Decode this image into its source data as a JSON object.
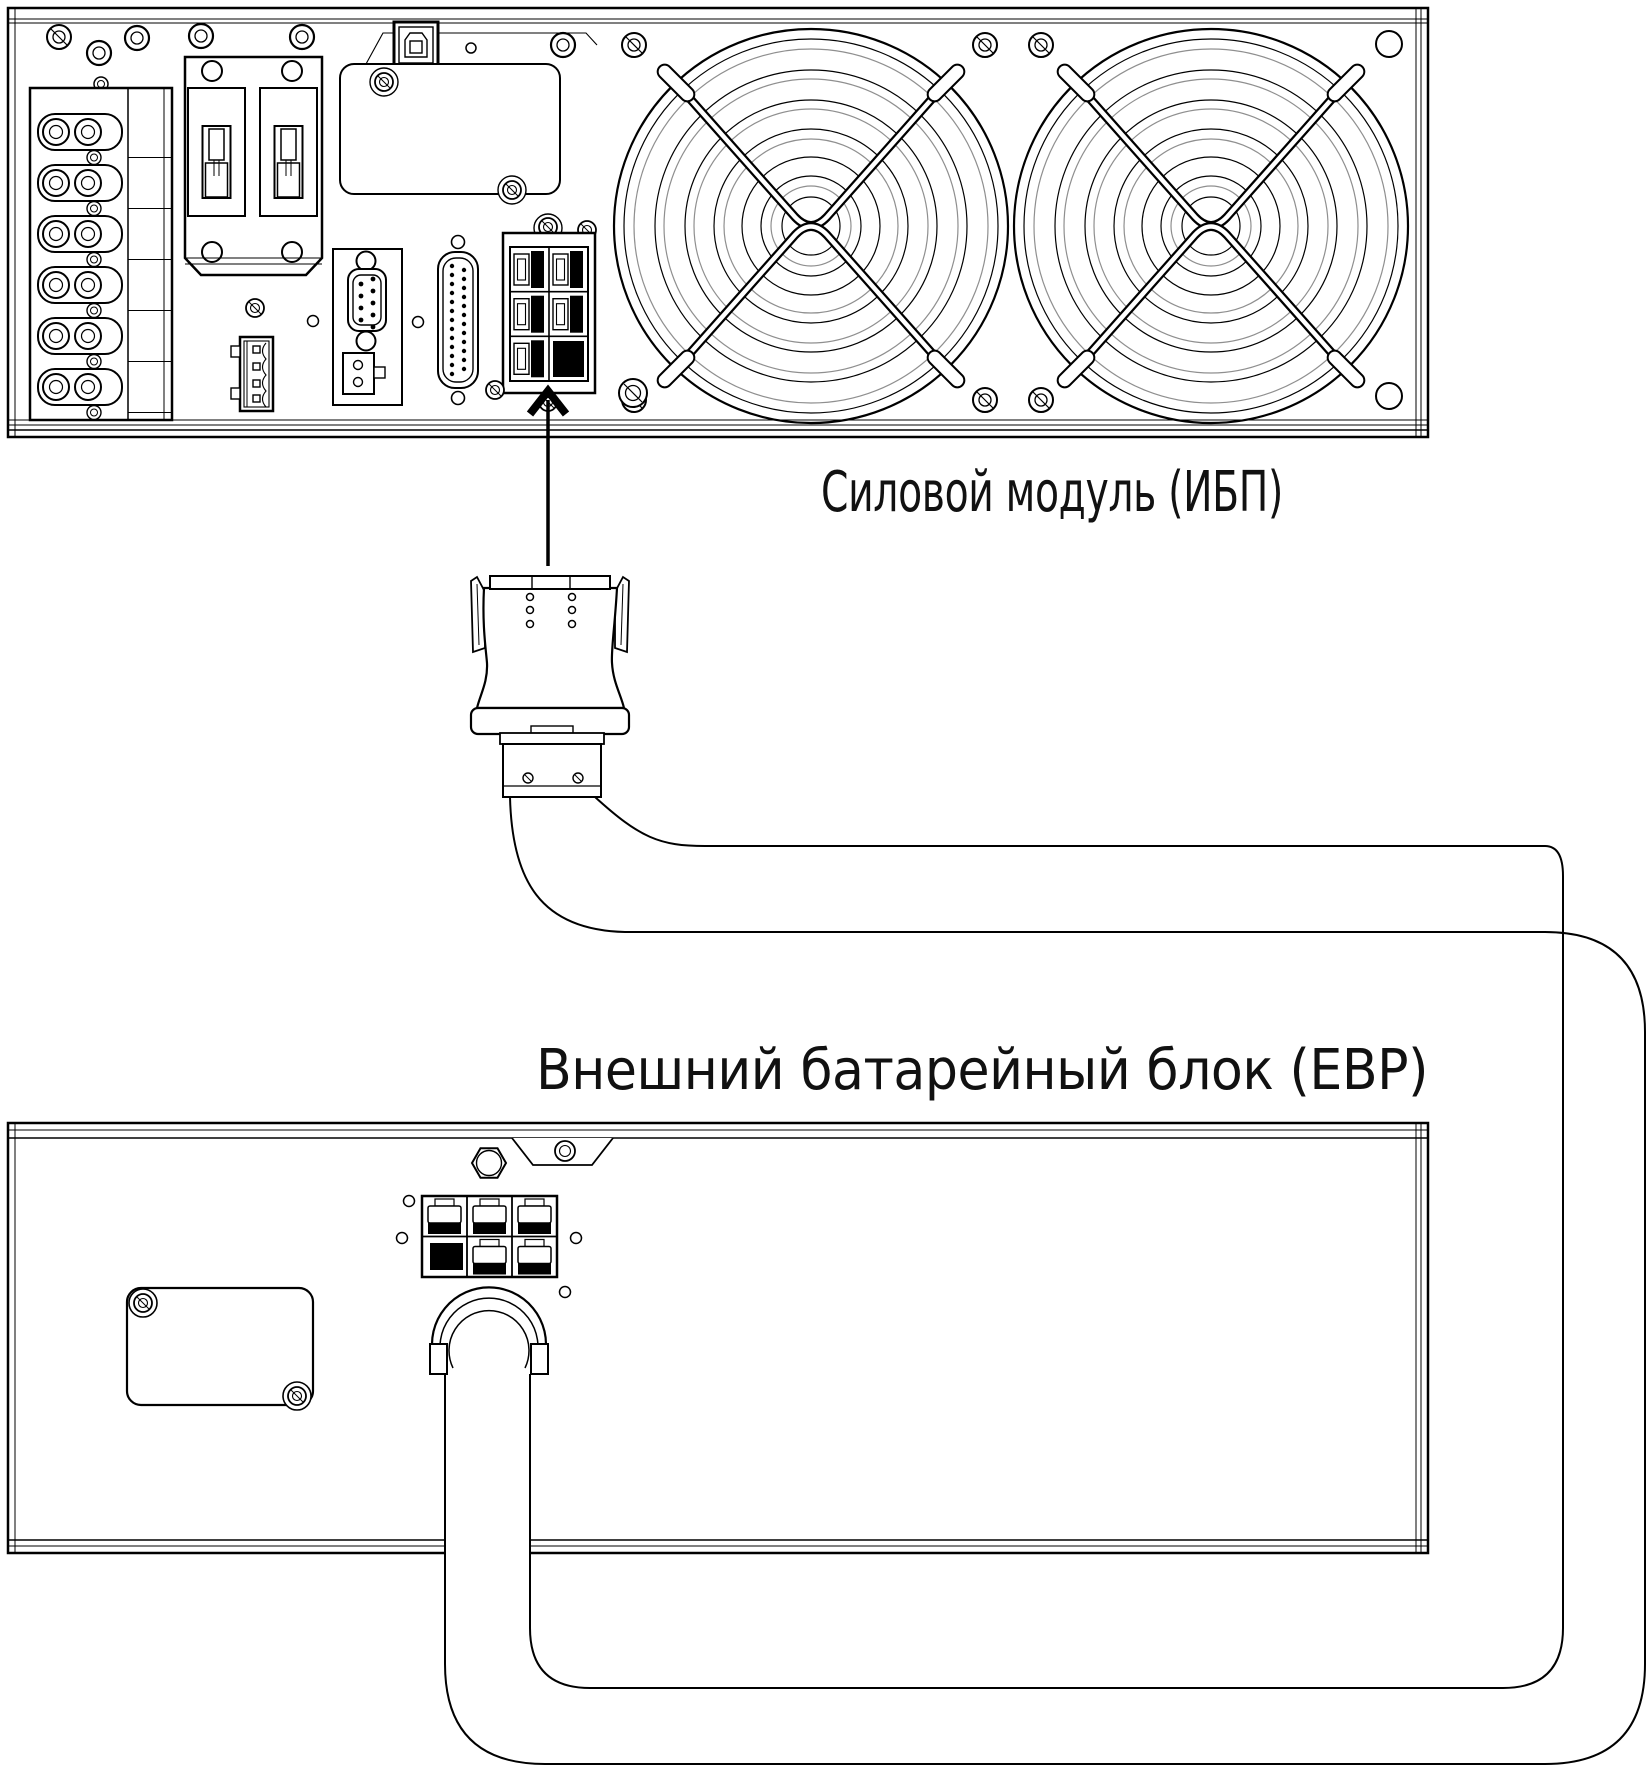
{
  "labels": {
    "ups": "Силовой модуль (ИБП)",
    "ebp": "Внешний батарейный блок (EBP)"
  },
  "colors": {
    "line": "#000000",
    "background": "#ffffff",
    "secondary_line": "#8f8f8f",
    "connector_fill": "#000000"
  }
}
